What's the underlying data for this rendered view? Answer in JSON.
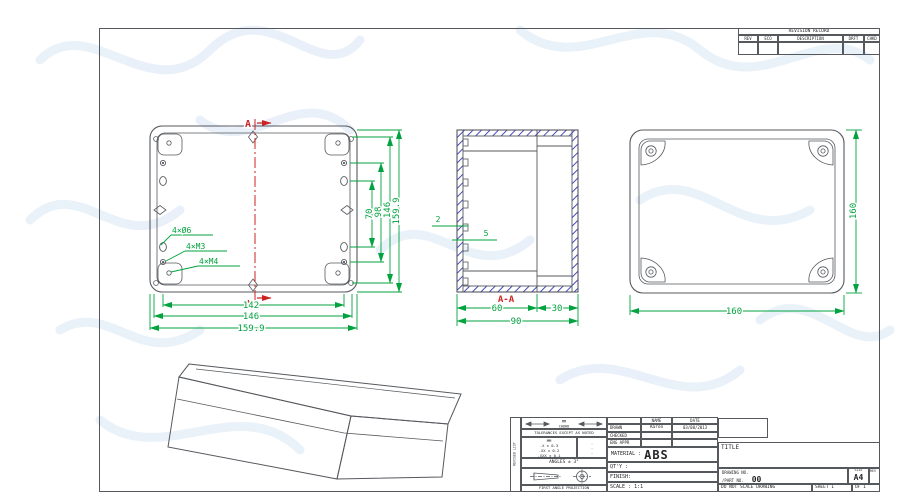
{
  "colors": {
    "line": "#55585d",
    "dim": "#00a33e",
    "section": "#cc2222",
    "hatch": "#3137b8",
    "watermark": "#e4edf8"
  },
  "revision_table": {
    "title": "REVISION RECORD",
    "col_rev": "REV",
    "col_eco": "ECO",
    "col_description": "DESCRIPTION",
    "col_drft": "DRFT",
    "col_chkd": "CHKD"
  },
  "front_view": {
    "section_mark": "A",
    "label_holes_a": "4×Ø6",
    "label_holes_b": "4×M3",
    "label_holes_c": "4×M4",
    "dim_bottom_1": "142",
    "dim_bottom_2": "146",
    "dim_bottom_3": "159.9",
    "dim_right_1": "70",
    "dim_right_2": "98",
    "dim_right_3": "146",
    "dim_right_4": "159.9"
  },
  "section_view": {
    "label": "A-A",
    "dim_wall": "2",
    "dim_rib": "5",
    "dim_body": "60",
    "dim_lid": "30",
    "dim_total": "90"
  },
  "back_view": {
    "dim_width": "160",
    "dim_height": "160"
  },
  "title_block": {
    "side_label": "REVISED LIST",
    "units_top": "MM",
    "units_bottom": "CHORD",
    "tolerances_note": "TOLERANCES EXCEPT AS NOTED",
    "tol_unit_header": "MM",
    "tol_row1": ".X ± 0.3",
    "tol_row2": ".XX ± 0.2",
    "tol_row3": ".XXX ± 0.1",
    "tol_dot": "·",
    "angles": "ANGLES ± 3°",
    "projection_caption": "FIRST ANGLE PROJECTION",
    "name_header": "NAME",
    "date_header": "DATE",
    "row_drawn": "DRAWN",
    "row_checked": "CHECKED",
    "row_eng": "ENG APPR",
    "drawn_name": "Aaron",
    "drawn_date": "03/08/2013",
    "material_label": "MATERIAL :",
    "material_value": "ABS",
    "qty_label": "QT'Y :",
    "finish_label": "FINISH:",
    "scale_label": "SCALE : 1:1",
    "title_label": "TITLE",
    "drawing_no_label": "DRAWING NO.",
    "part_no_label": "/PART NO.",
    "part_no_value": "00",
    "size_label": "SIZE",
    "size_value": "A4",
    "rev_label": "REV",
    "do_not_scale": "DO NOT SCALE DRAWING",
    "sheet_label": "SHEET 1",
    "of_label": "OF 1"
  }
}
